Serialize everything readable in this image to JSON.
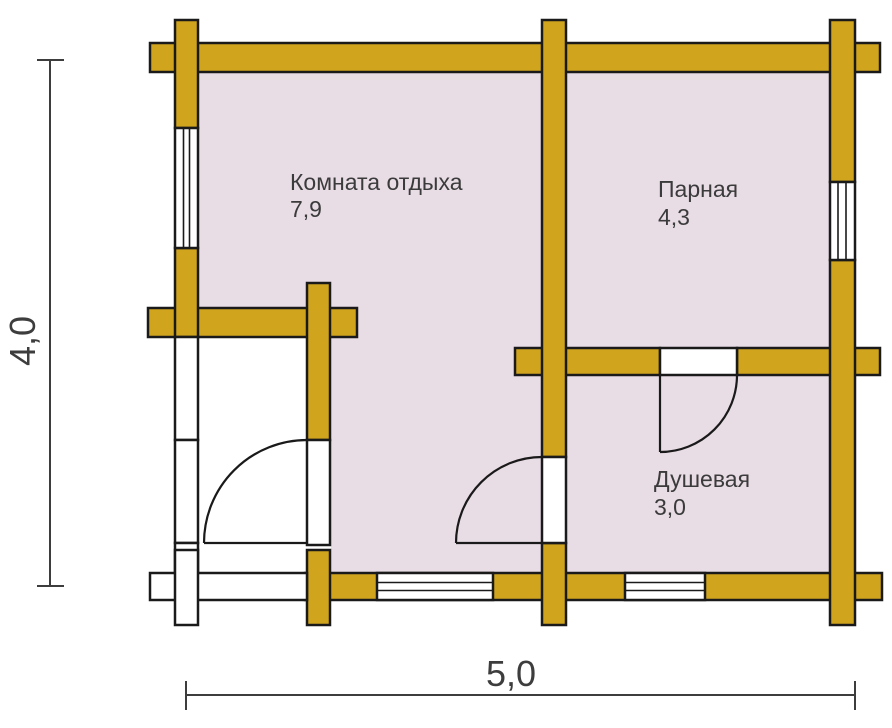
{
  "rooms": [
    {
      "name": "Комната отдыха",
      "area": "7,9"
    },
    {
      "name": "Парная",
      "area": "4,3"
    },
    {
      "name": "Душевая",
      "area": "3,0"
    }
  ],
  "dimensions": {
    "height_label": "4,0",
    "width_label": "5,0"
  },
  "colors": {
    "wall": "#d1a41e",
    "room": "#e8dce5",
    "window": "#ffffff",
    "outline": "#1a1a1a",
    "dim": "#3d3d3d",
    "text": "#3b3b3b"
  }
}
